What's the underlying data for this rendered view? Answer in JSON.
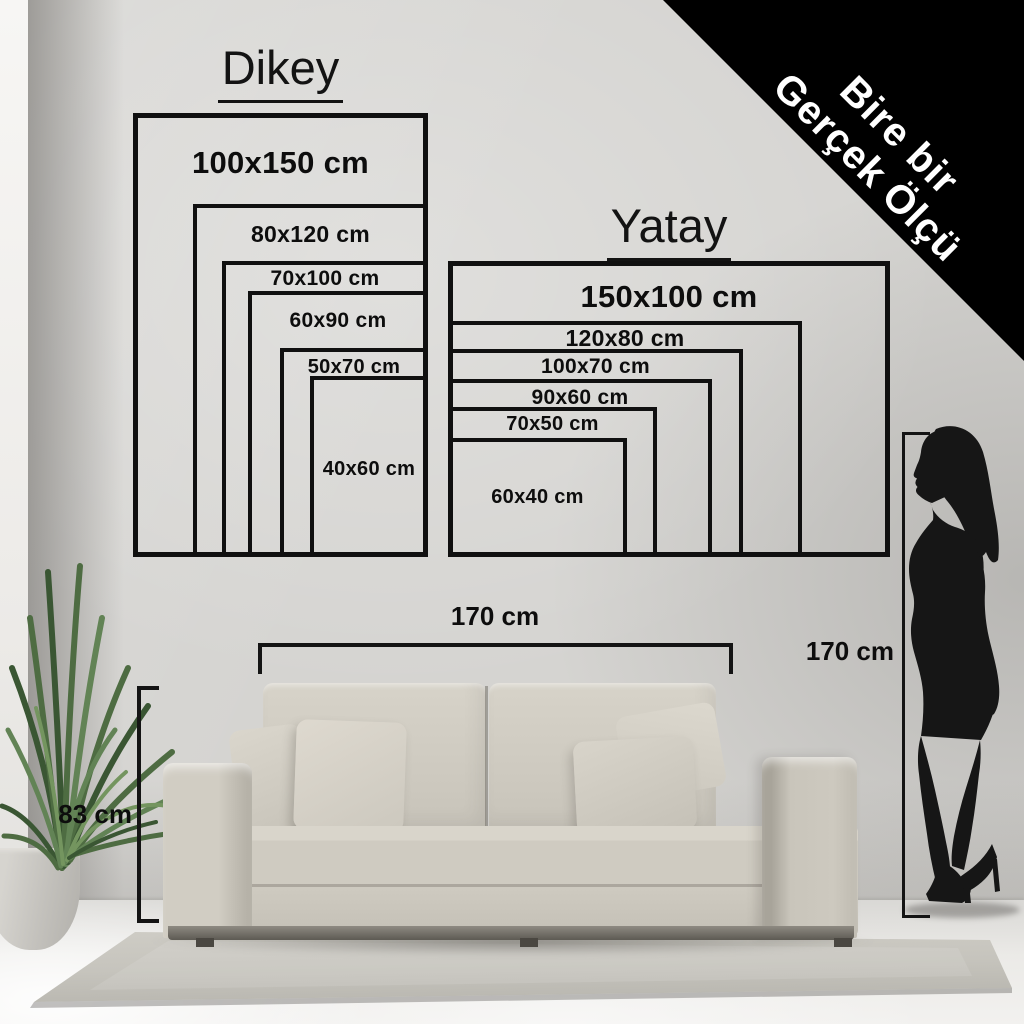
{
  "banner": {
    "line1": "Bire bir",
    "line2": "Gerçek Ölçü"
  },
  "charts": {
    "dikey": {
      "title": "Dikey",
      "orientation": "vertical",
      "sizes": [
        {
          "label": "100x150 cm",
          "width_cm": 100,
          "height_cm": 150
        },
        {
          "label": "80x120 cm",
          "width_cm": 80,
          "height_cm": 120
        },
        {
          "label": "70x100 cm",
          "width_cm": 70,
          "height_cm": 100
        },
        {
          "label": "60x90 cm",
          "width_cm": 60,
          "height_cm": 90
        },
        {
          "label": "50x70 cm",
          "width_cm": 50,
          "height_cm": 70
        },
        {
          "label": "40x60 cm",
          "width_cm": 40,
          "height_cm": 60
        }
      ]
    },
    "yatay": {
      "title": "Yatay",
      "orientation": "horizontal",
      "sizes": [
        {
          "label": "150x100 cm",
          "width_cm": 150,
          "height_cm": 100
        },
        {
          "label": "120x80 cm",
          "width_cm": 120,
          "height_cm": 80
        },
        {
          "label": "100x70 cm",
          "width_cm": 100,
          "height_cm": 70
        },
        {
          "label": "90x60 cm",
          "width_cm": 90,
          "height_cm": 60
        },
        {
          "label": "70x50 cm",
          "width_cm": 70,
          "height_cm": 50
        },
        {
          "label": "60x40 cm",
          "width_cm": 60,
          "height_cm": 40
        }
      ]
    }
  },
  "measurements": {
    "sofa_width": {
      "label": "170 cm"
    },
    "sofa_height": {
      "label": "83 cm"
    },
    "person_height": {
      "label": "170 cm"
    }
  },
  "colors": {
    "line": "#141414",
    "banner_bg": "#000000",
    "banner_text": "#ffffff",
    "wall": "#d5d4d1",
    "sofa": "#cbc7bd",
    "rug": "#c7c5be",
    "plant": "#4e6c42",
    "silhouette": "#161616"
  }
}
